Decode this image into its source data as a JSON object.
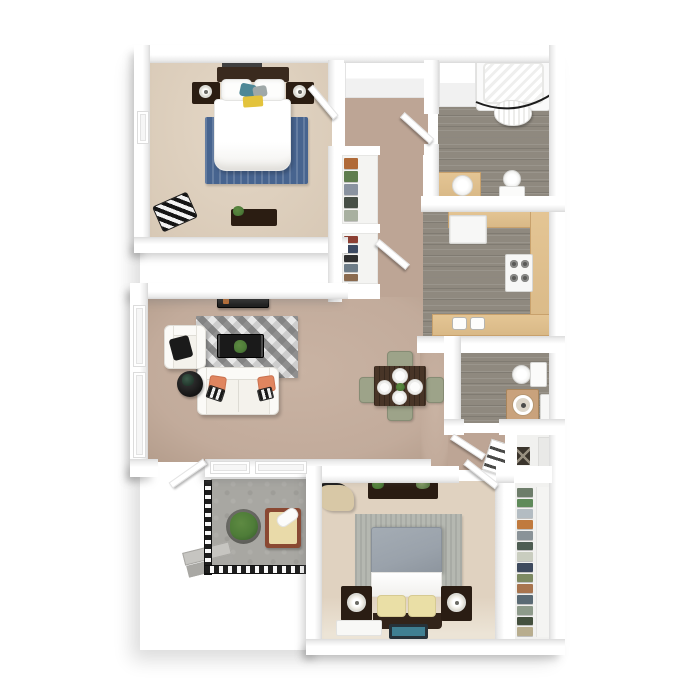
{
  "scene": {
    "type": "3d-floor-plan-render",
    "title": "Two-bedroom apartment 3D floor plan",
    "description": "Top-down 3D architectural rendering of a two-bedroom, two-bathroom apartment with kitchen, living room, dining area, patio and walk-in closet on a white background",
    "background": "#ffffff"
  },
  "palette": {
    "carpetBed1": "#e4d7c6",
    "carpetBed2": "#e0d2c0",
    "carpetLiving": "#c2ab9b",
    "carpetHall": "#bda595",
    "woodFloor": "#8f897f",
    "counter": "#e4c594",
    "counterEdge": "#c8a16c",
    "concrete": "#a8a7a2",
    "railing": "#1e1e1e",
    "rugBlue": "#47648f",
    "rugGray": "#b5b8b1",
    "sofaWhite": "#f4f2ec",
    "coral": "#e0855f",
    "black": "#1a1a1a",
    "duvetGray": "#9aa2ab",
    "pillowCream": "#eadfa6",
    "headboard": "#32241a",
    "furnDark": "#2b1d12",
    "sage": "#9da389",
    "tableBrown": "#483527",
    "plantGreen": "#4e7c38",
    "plantDark": "#35592b",
    "teal": "#4e8796",
    "yellow": "#e3c33c",
    "trayTeal": "#3f7f92",
    "washerTan": "#c9a27c",
    "closetFloor": "#f1f1ef"
  },
  "rooms": [
    {
      "id": "bedroom-1",
      "label": "Bedroom 1",
      "floor": "beige carpet",
      "contents": [
        "queen bed with white duvet",
        "blue striped area rug",
        "two nightstands with lamps",
        "wall art",
        "dresser with plant",
        "chevron accent pillow",
        "window"
      ]
    },
    {
      "id": "hallway",
      "label": "Hallway",
      "floor": "tan carpet",
      "contents": [
        "linen closet with shelves",
        "two reach-in closets with hanging clothes"
      ]
    },
    {
      "id": "bathroom-1",
      "label": "Bathroom 1",
      "floor": "gray wood",
      "contents": [
        "bathtub with curved curtain rod",
        "storage shelves",
        "vanity with round sink",
        "toilet"
      ]
    },
    {
      "id": "kitchen",
      "label": "Kitchen",
      "floor": "gray wood",
      "contents": [
        "U-shaped counter",
        "refrigerator",
        "range with four burners",
        "double sink"
      ]
    },
    {
      "id": "living-room",
      "label": "Living Room",
      "floor": "tan carpet",
      "contents": [
        "media console",
        "geometric gray rug",
        "black coffee table with plant",
        "white sofa with coral pillows",
        "white armchair with black pillow",
        "round side table with plant",
        "two windows",
        "entry door"
      ]
    },
    {
      "id": "dining-area",
      "label": "Dining Area",
      "floor": "tan carpet",
      "contents": [
        "square dining table with four place settings",
        "four sage chairs"
      ]
    },
    {
      "id": "bathroom-2",
      "label": "Bathroom 2 / Laundry",
      "floor": "gray wood",
      "contents": [
        "toilet",
        "washer with round lid",
        "dryer"
      ]
    },
    {
      "id": "rear-hall",
      "label": "Rear Hall",
      "floor": "tan carpet",
      "contents": [
        "shelf unit",
        "linen closet"
      ]
    },
    {
      "id": "patio",
      "label": "Patio",
      "floor": "concrete",
      "contents": [
        "potted plant",
        "lounge chair with cushion",
        "black railing",
        "step bench"
      ]
    },
    {
      "id": "bedroom-2",
      "label": "Bedroom 2",
      "floor": "beige carpet",
      "contents": [
        "bed with gray duvet and cream pillows",
        "striped gray rug",
        "two nightstands with round lamps",
        "dresser with plants",
        "accent chair",
        "white bench",
        "blue tray"
      ]
    },
    {
      "id": "walk-in-closet",
      "label": "Walk-in Closet",
      "floor": "white",
      "contents": [
        "hanging clothes rail",
        "shelf",
        "shoe rack"
      ]
    }
  ],
  "clothes": {
    "hallCloset1": [
      "#b06a38",
      "#5f7d4e",
      "#8a93a0",
      "#474f46",
      "#a8b0a0"
    ],
    "hallCloset2": [
      "#8d4034",
      "#3c4a63",
      "#2f2f2f",
      "#6e7d88",
      "#8a6a4e"
    ],
    "walkIn": [
      "#6d7d6a",
      "#5f8a5a",
      "#b3bcc2",
      "#c07a3e",
      "#8a9398",
      "#4e5d52",
      "#c9cdbf",
      "#3e4a5e",
      "#7d8a62",
      "#a8744e",
      "#5a6a74",
      "#8d9a8a",
      "#44503e",
      "#b8ad8e"
    ]
  }
}
